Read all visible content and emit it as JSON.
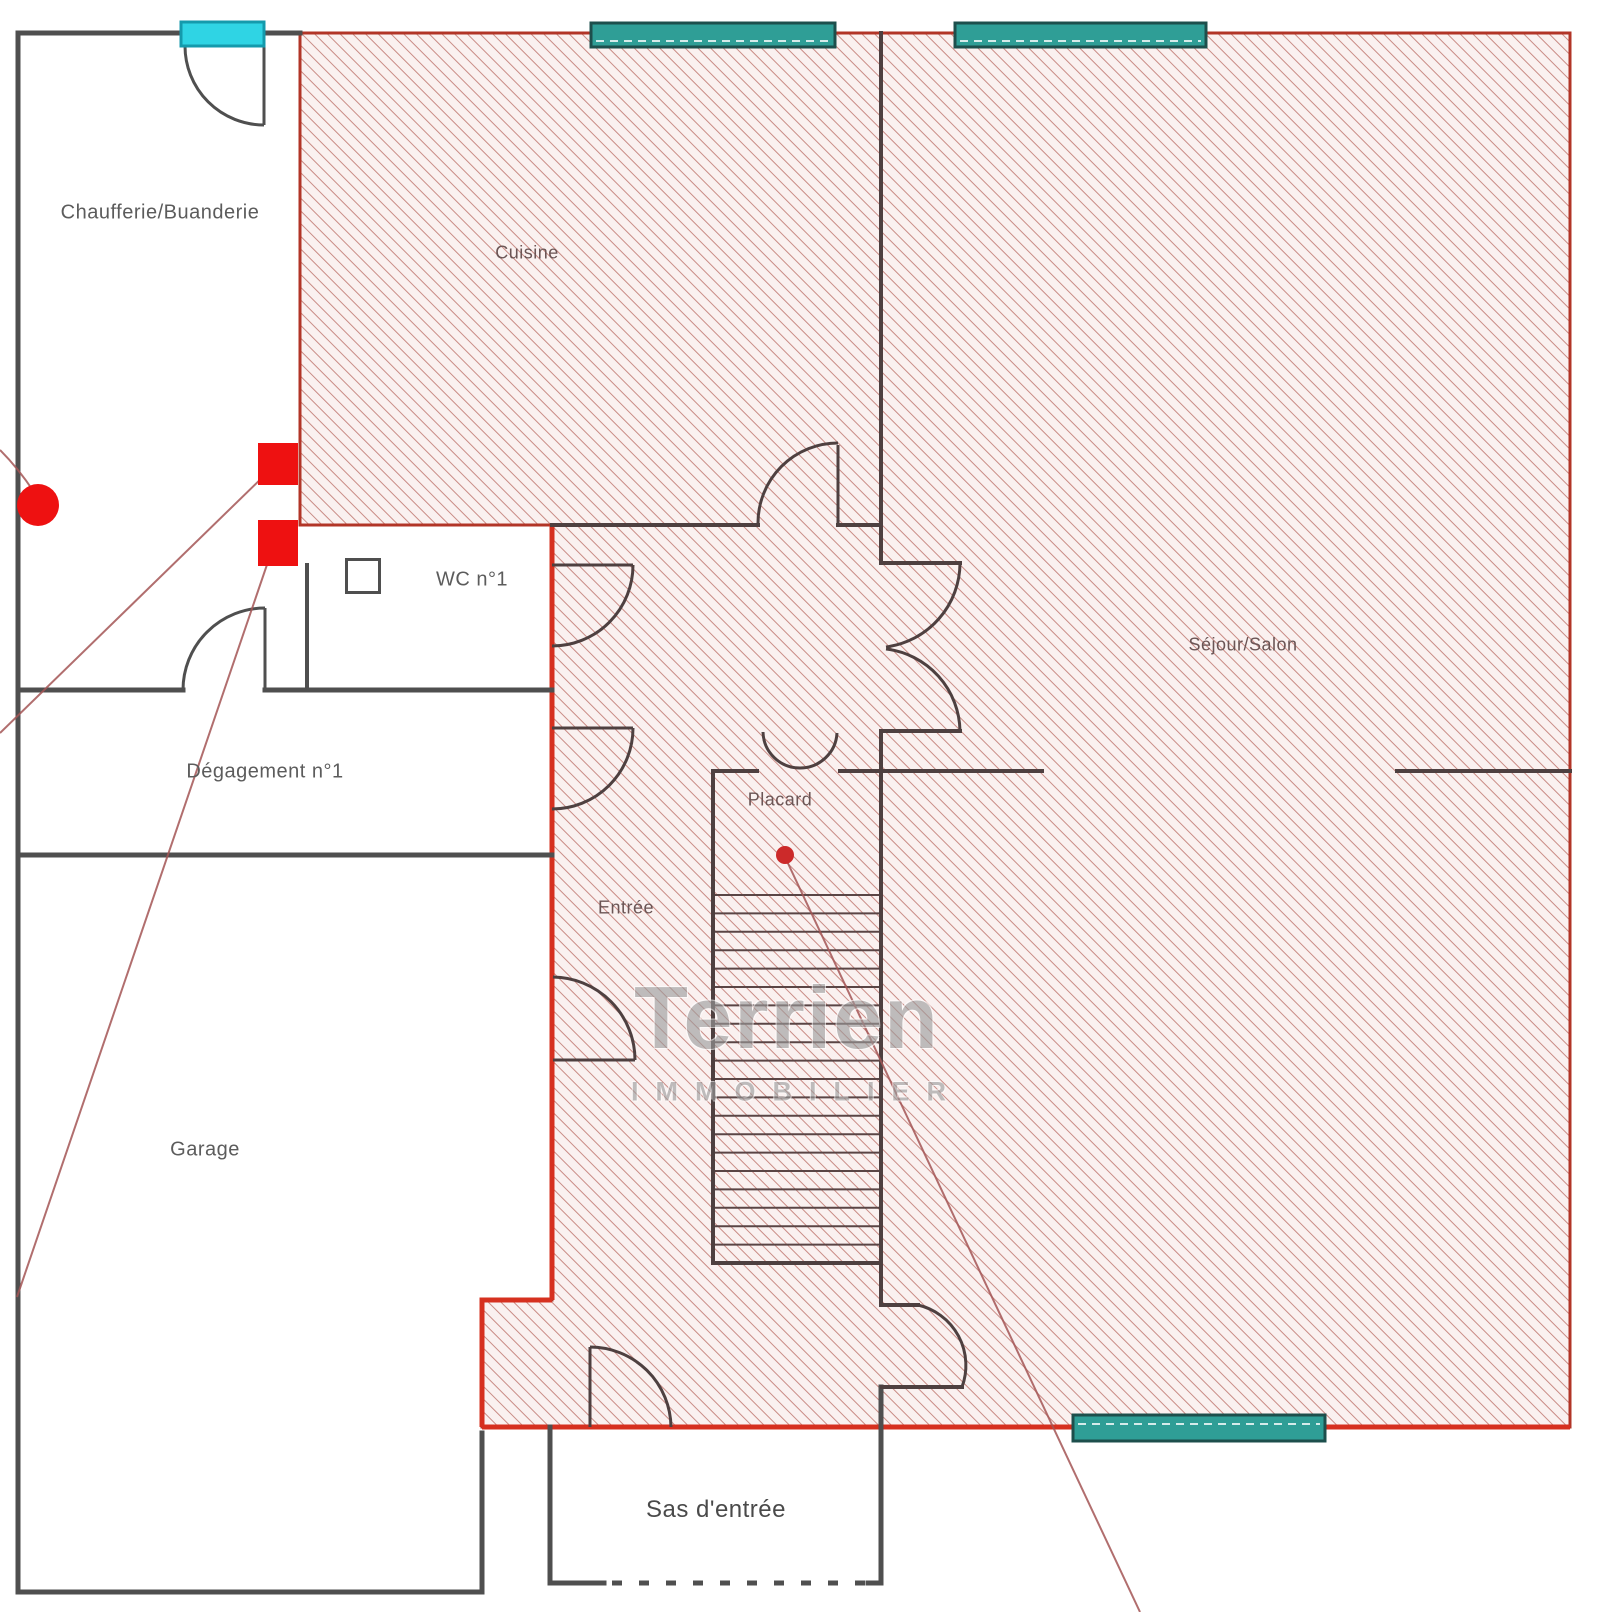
{
  "plan": {
    "title": "Floor plan with highlighted living area",
    "rooms": [
      {
        "id": "chaufferie",
        "label": "Chaufferie/Buanderie",
        "highlighted": false
      },
      {
        "id": "cuisine",
        "label": "Cuisine",
        "highlighted": true
      },
      {
        "id": "wc1",
        "label": "WC n°1",
        "highlighted": false
      },
      {
        "id": "degagement1",
        "label": "Dégagement n°1",
        "highlighted": false
      },
      {
        "id": "garage",
        "label": "Garage",
        "highlighted": false
      },
      {
        "id": "entree",
        "label": "Entrée",
        "highlighted": true
      },
      {
        "id": "placard",
        "label": "Placard",
        "highlighted": true
      },
      {
        "id": "sejour",
        "label": "Séjour/Salon",
        "highlighted": true
      },
      {
        "id": "sas",
        "label": "Sas d'entrée",
        "highlighted": false
      }
    ],
    "watermark": {
      "brand": "Terrien",
      "subtitle": "IMMOBILIER"
    },
    "markers": {
      "red_square_count": 2,
      "red_circle_count": 1,
      "placard_dot_count": 1
    },
    "colors": {
      "hatch-border": "#b23527",
      "hatch-line": "#c98b85",
      "hatch-bg": "#faf1f0",
      "highlight-red": "#d6301f",
      "wall-gray": "#4f4f4f",
      "wall-dark": "#4e4040",
      "stair-line": "#5a4545",
      "leader-red": "#a35555",
      "window-teal": "#2f9e96",
      "window-teal-border": "#1d4f4c",
      "door-cyan": "#2fd4e4",
      "door-cyan-border": "#149aac",
      "marker-red": "#ee1111",
      "marker-dot": "#cc2a2a"
    }
  }
}
